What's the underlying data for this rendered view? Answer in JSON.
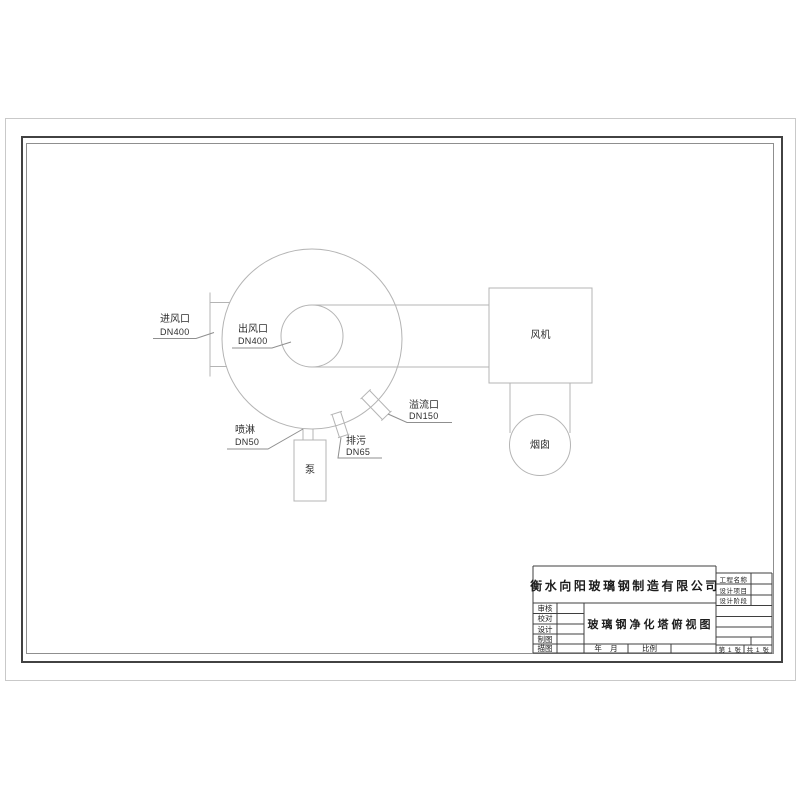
{
  "colors": {
    "drawing_line": "#b4b4b4",
    "leader_line": "#8f8f8f",
    "label_text": "#2e2e2e",
    "frame_thick": "#424242",
    "frame_thin": "#8f8f8f",
    "sheet_edge": "#c9c9c9",
    "titleblock_line": "#3f3f3f"
  },
  "drawing": {
    "inlet_label": "进风口",
    "inlet_size": "DN400",
    "outlet_label": "出风口",
    "outlet_size": "DN400",
    "spray_label": "喷淋",
    "spray_size": "DN50",
    "drain_label": "排污",
    "drain_size": "DN65",
    "overflow_label": "溢流口",
    "overflow_size": "DN150",
    "fan_label": "风机",
    "chimney_label": "烟囱",
    "pump_label": "泵"
  },
  "title_block": {
    "company": "衡水向阳玻璃钢制造有限公司",
    "drawing_title": "玻璃钢净化塔俯视图",
    "left_rows": [
      "审核",
      "校对",
      "设计",
      "制图",
      "描图"
    ],
    "right_rows": [
      "工程名称",
      "设计项目",
      "设计阶段"
    ],
    "date_label": "年    月",
    "scale_label": "比例",
    "sheet_no": "第 1 张",
    "sheet_total": "共 1 张"
  }
}
